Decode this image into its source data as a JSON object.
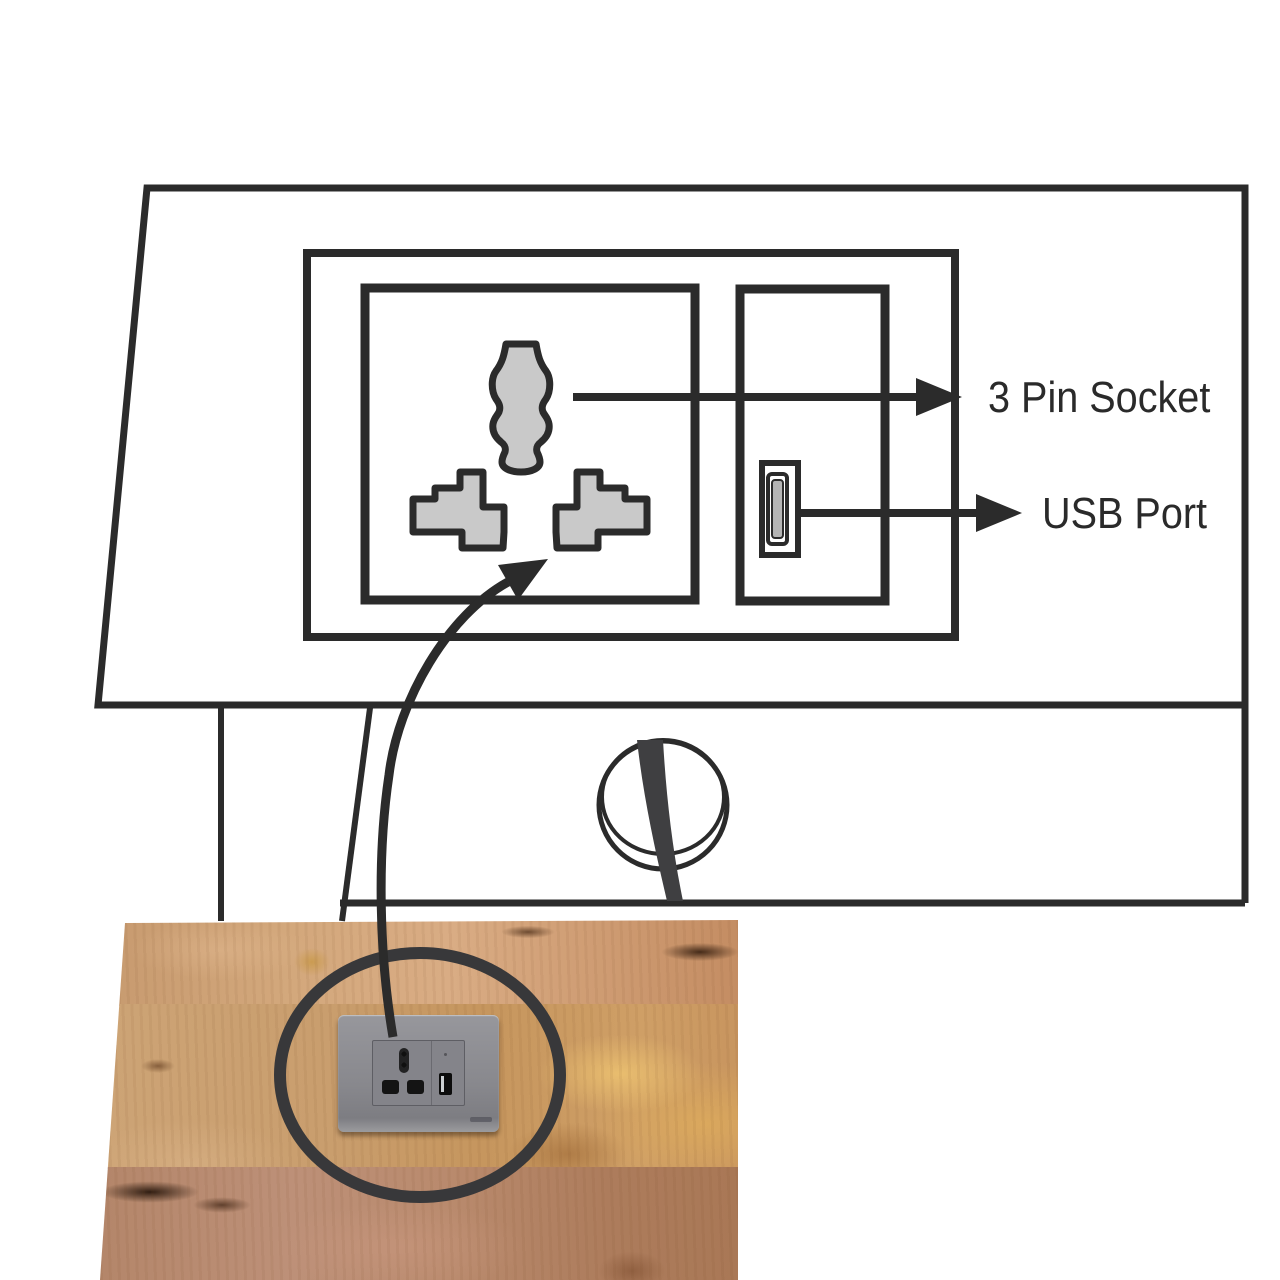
{
  "diagram": {
    "title_labels": {
      "pin_socket": "3 Pin Socket",
      "usb_port": "USB Port"
    },
    "icons": [
      "three-pin-socket-icon",
      "usb-port-icon",
      "cable-grommet-icon",
      "annotation-circle-icon",
      "callout-arrow-icon"
    ],
    "colors": {
      "line": "#2b2b2b",
      "pin_fill": "#c9c9c9",
      "cable": "#3f3f41",
      "annotation_circle": "#38383a",
      "plate_gray": "#8b8b90",
      "text": "#2a2a2a",
      "wood_light": "#d3a87c",
      "wood_mid": "#c6965e",
      "wood_dark": "#ad7c5c",
      "background": "#ffffff"
    }
  }
}
